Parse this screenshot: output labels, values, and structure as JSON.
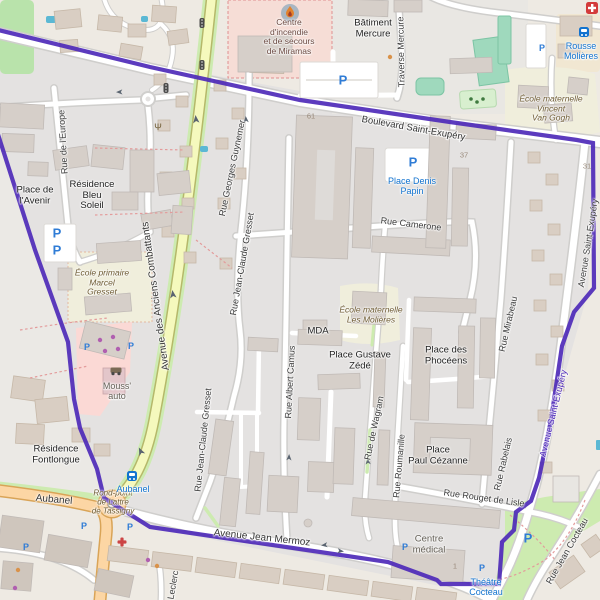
{
  "map": {
    "streets": {
      "boulevard_saint_exupery": "Boulevard Saint-Exupéry",
      "avenue_des_anciens_combattants": "Avenue des Anciens Combattants",
      "avenue_saint_exupery": "Avenue Saint-Exupéry",
      "avenue_saint_exupery_boundary": "Avenue Saint-Exupéry",
      "avenue_jean_mermoz": "Avenue Jean Mermoz",
      "traverse_mercure": "Traverse Mercure",
      "rue_de_leurope": "Rue de l'Europe",
      "rue_georges_guynemer": "Rue Georges Guynemer",
      "rue_jean_claude_gresset": "Rue Jean-Claude Gresset",
      "rue_jean_claude_gresset_2": "Rue Jean-Claude Gresset",
      "rue_albert_camus": "Rue Albert Camus",
      "rue_camerone": "Rue Camerone",
      "rue_de_wagram": "Rue de Wagram",
      "rue_roumanille": "Rue Roumanille",
      "rue_mirabeau": "Rue Mirabeau",
      "rue_rabelais": "Rue Rabelais",
      "rue_rouget_de_lisle": "Rue Rouget de Lisle",
      "rue_jean_cocteau": "Rue Jean Cocteau",
      "aubanel": "Aubanel",
      "leclerc": "Leclerc"
    },
    "places": {
      "batiment_mercure": [
        "Bâtiment",
        "Mercure"
      ],
      "place_de_lavenir": [
        "Place de",
        "l'Avenir"
      ],
      "residence_bleu_soleil": [
        "Résidence",
        "Bleu",
        "Soleil"
      ],
      "residence_fontlongue": [
        "Résidence",
        "Fontlongue"
      ],
      "place_gustave_zede": [
        "Place Gustave",
        "Zédé"
      ],
      "place_des_phoceens": [
        "Place des",
        "Phocéens"
      ],
      "place_paul_cezanne": [
        "Place",
        "Paul Cézanne"
      ],
      "mda": "MDA",
      "mouss_auto": [
        "Mouss'",
        "auto"
      ],
      "centre_medical": [
        "Centre",
        "médical"
      ],
      "rond_point_tassigny": [
        "Rond-point",
        "de Lattre",
        "de Tassigny"
      ]
    },
    "amenities": {
      "centre_incendie": [
        "Centre",
        "d'incendie",
        "et de secours",
        "de Miramas"
      ],
      "ecole_primaire_gresset": [
        "École primaire",
        "Marcel",
        "Gresset"
      ],
      "ecole_maternelle_molieres": [
        "École maternelle",
        "Les Molières"
      ],
      "ecole_maternelle_van_gogh": [
        "École maternelle",
        "Vincent",
        "Van Gogh"
      ]
    },
    "transit": {
      "rousse_molieres": [
        "Rousse",
        "Molières"
      ],
      "place_denis_papin": [
        "Place Denis",
        "Papin"
      ],
      "aubanel_stop": "Aubanel",
      "theatre_cocteau": [
        "Théâtre",
        "Cocteau"
      ]
    },
    "house_numbers": {
      "n61": "61",
      "n37": "37",
      "n31": "31",
      "n1": "1"
    },
    "icons": {
      "parking_glyph": "P",
      "fountain_glyph": "Ψ"
    },
    "colors": {
      "boundary": "#4e2ab8",
      "road_secondary": "#f5f9bd",
      "road_secondary_casing": "#b5b86a",
      "road_primary": "#fcd6a4",
      "road_primary_casing": "#d9a457",
      "park": "#cdebb0",
      "pitch": "#9fd9bd",
      "school_ground": "#f0eedc",
      "fire_station_ground": "#f6ddd6",
      "retail": "#fbd9d5",
      "residential": "#e4e2e1",
      "building": "#d6cfc9",
      "transit": "#1273cf",
      "parking": "#2f7cd6",
      "poi_text": "#6e5b33"
    }
  }
}
